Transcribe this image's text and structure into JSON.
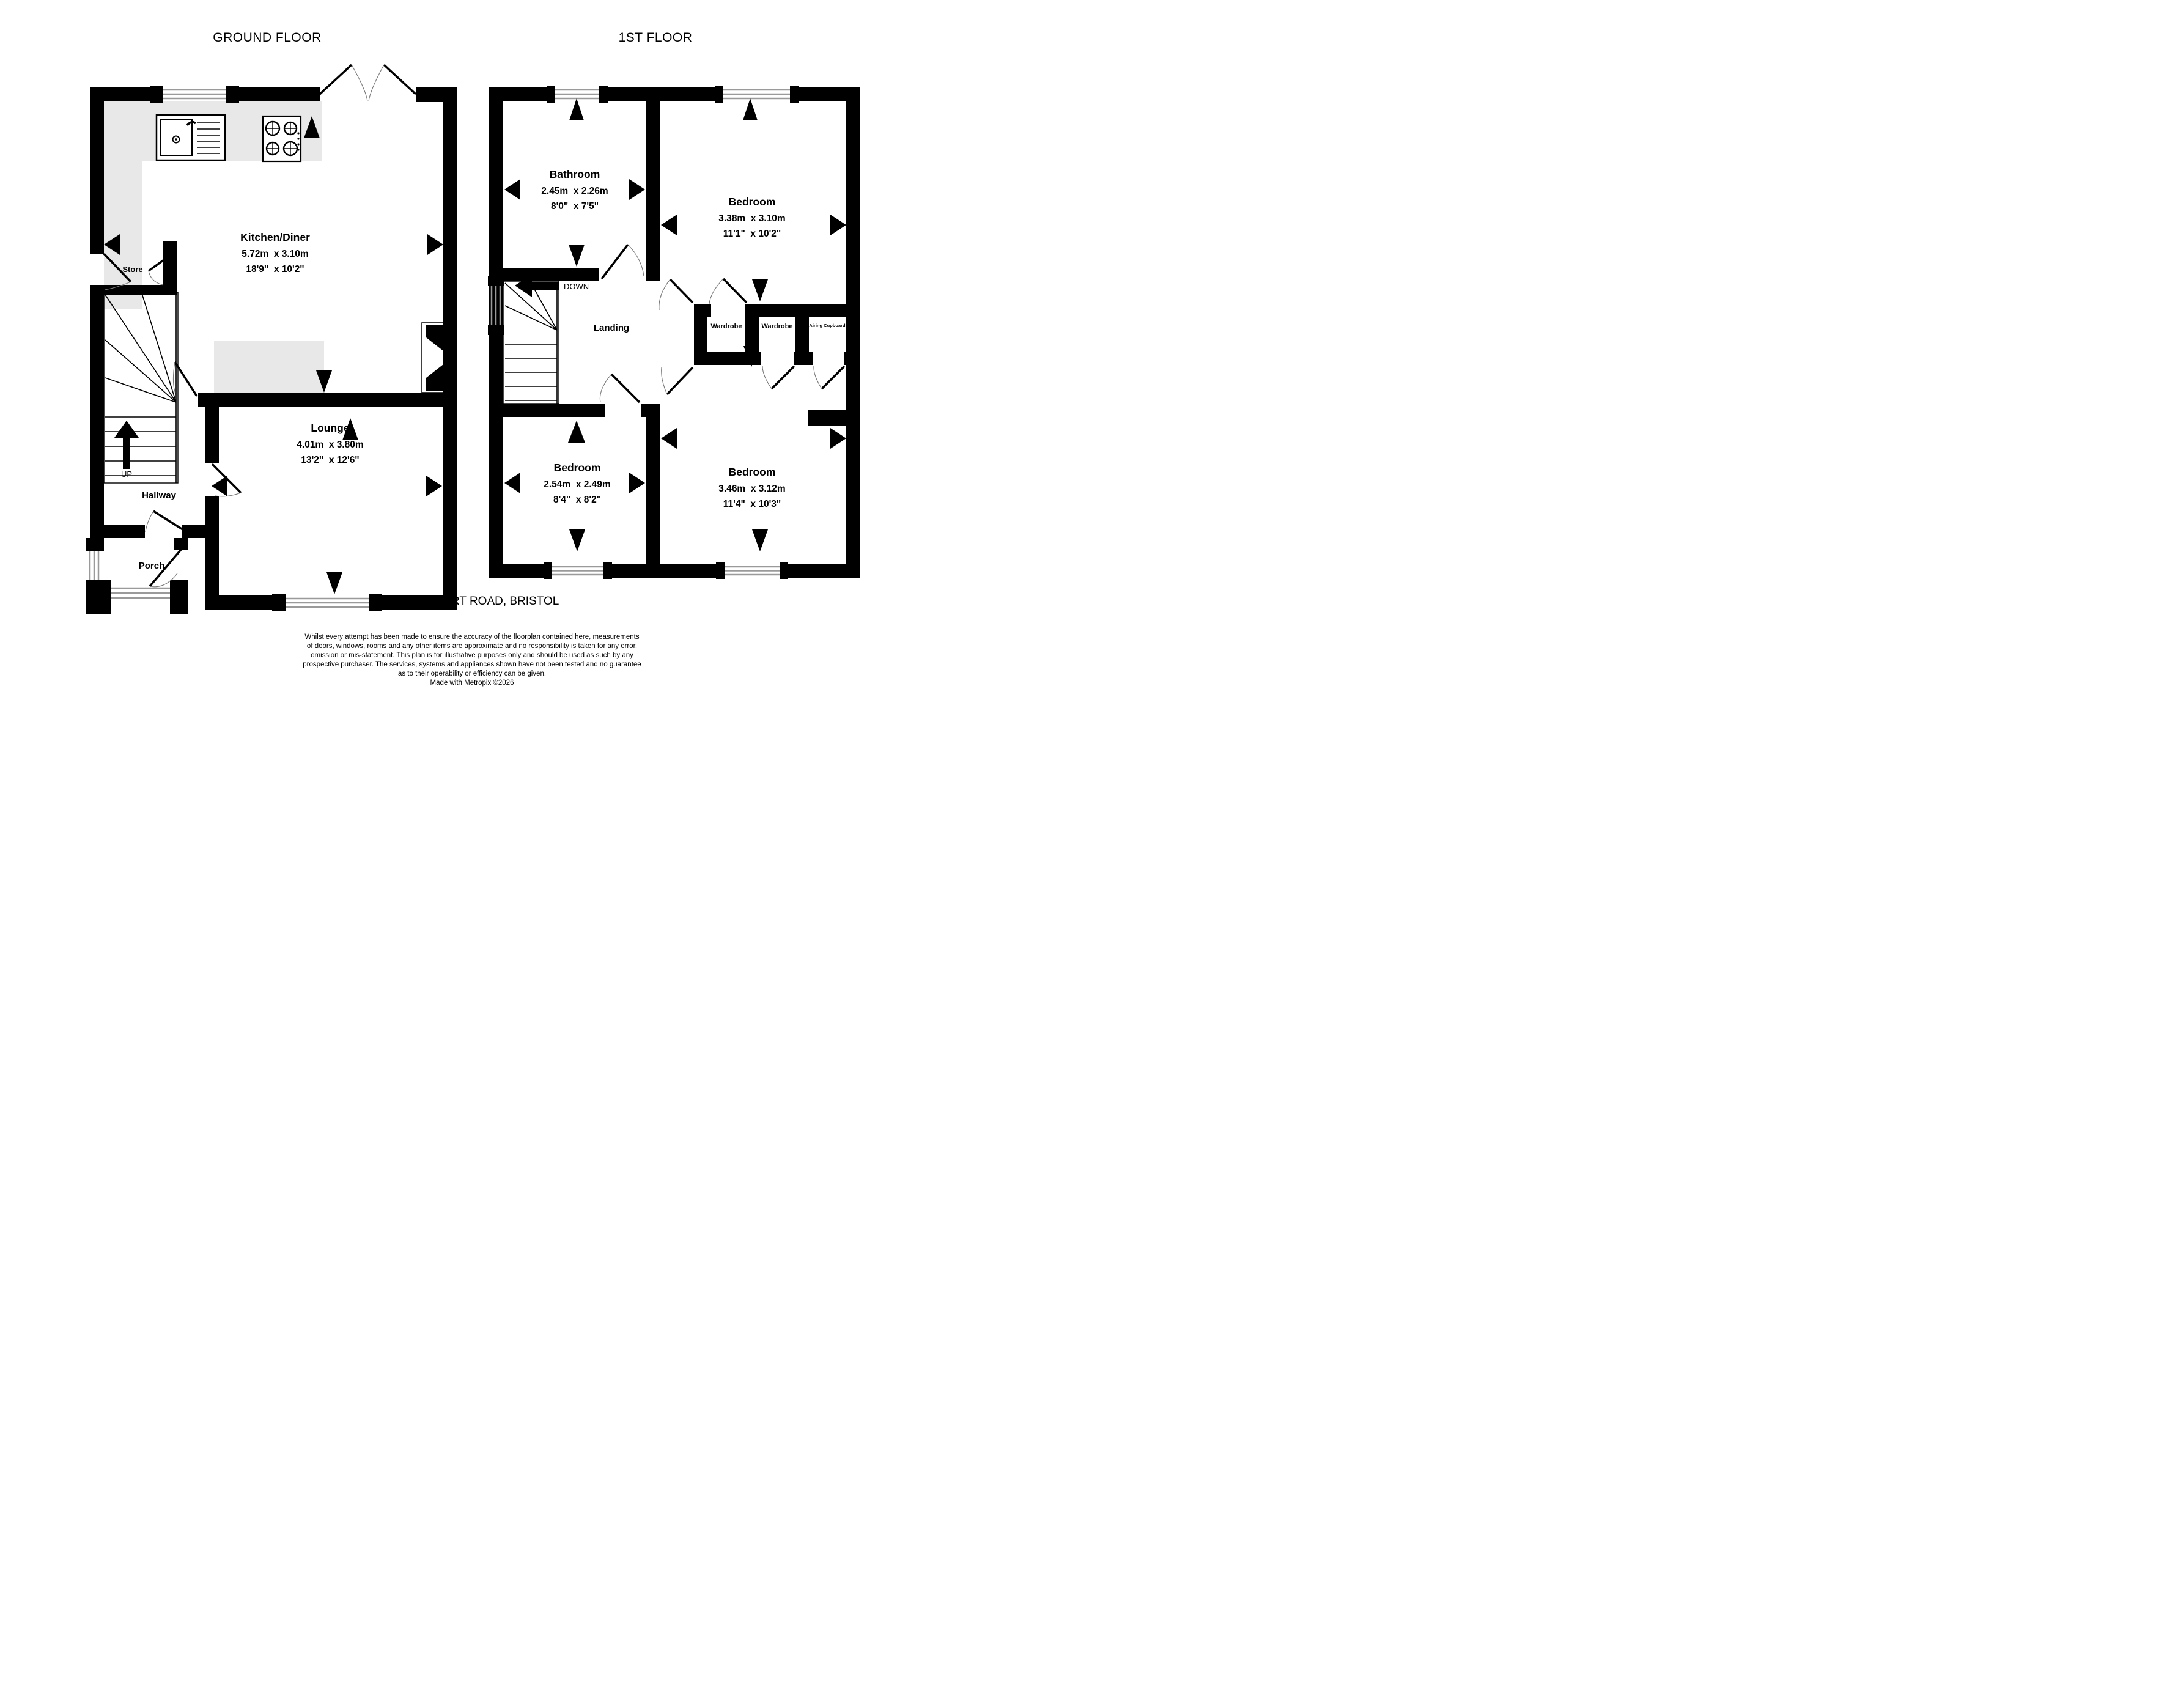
{
  "titles": {
    "ground": "GROUND FLOOR",
    "first": "1ST FLOOR"
  },
  "address": "LYPPINCOURT ROAD, BRISTOL",
  "ground_floor": {
    "kitchen": {
      "name": "Kitchen/Diner",
      "metric": "5.72m  x 3.10m",
      "imperial": "18'9\"  x 10'2\""
    },
    "lounge": {
      "name": "Lounge",
      "metric": "4.01m  x 3.80m",
      "imperial": "13'2\"  x 12'6\""
    },
    "store": {
      "name": "Store"
    },
    "hallway": {
      "name": "Hallway"
    },
    "porch": {
      "name": "Porch"
    },
    "stairs_label": "UP"
  },
  "first_floor": {
    "bathroom": {
      "name": "Bathroom",
      "metric": "2.45m  x 2.26m",
      "imperial": "8'0\"  x 7'5\""
    },
    "bedroom1": {
      "name": "Bedroom",
      "metric": "3.38m  x 3.10m",
      "imperial": "11'1\"  x 10'2\""
    },
    "bedroom2": {
      "name": "Bedroom",
      "metric": "2.54m  x 2.49m",
      "imperial": "8'4\"  x 8'2\""
    },
    "bedroom3": {
      "name": "Bedroom",
      "metric": "3.46m  x 3.12m",
      "imperial": "11'4\"  x 10'3\""
    },
    "landing": {
      "name": "Landing"
    },
    "wardrobe1": {
      "name": "Wardrobe"
    },
    "wardrobe2": {
      "name": "Wardrobe"
    },
    "airing_cupboard": {
      "name": "Airing Cupboard"
    },
    "stairs_label": "DOWN"
  },
  "footer": {
    "disclaimer": [
      "Whilst every attempt has been made to ensure the accuracy of the floorplan contained here, measurements",
      "of doors, windows, rooms and any other items are approximate and no responsibility is taken for any error,",
      "omission or mis-statement. This plan is for illustrative purposes only and should be used as such by any",
      "prospective purchaser. The services, systems and appliances shown have not been tested and no guarantee",
      "as to their operability or efficiency can be given."
    ],
    "credit": "Made with Metropix ©2026"
  },
  "colors": {
    "wall": "#000000",
    "counter": "#e8e8e8",
    "glazing": "#9a9a9a"
  }
}
